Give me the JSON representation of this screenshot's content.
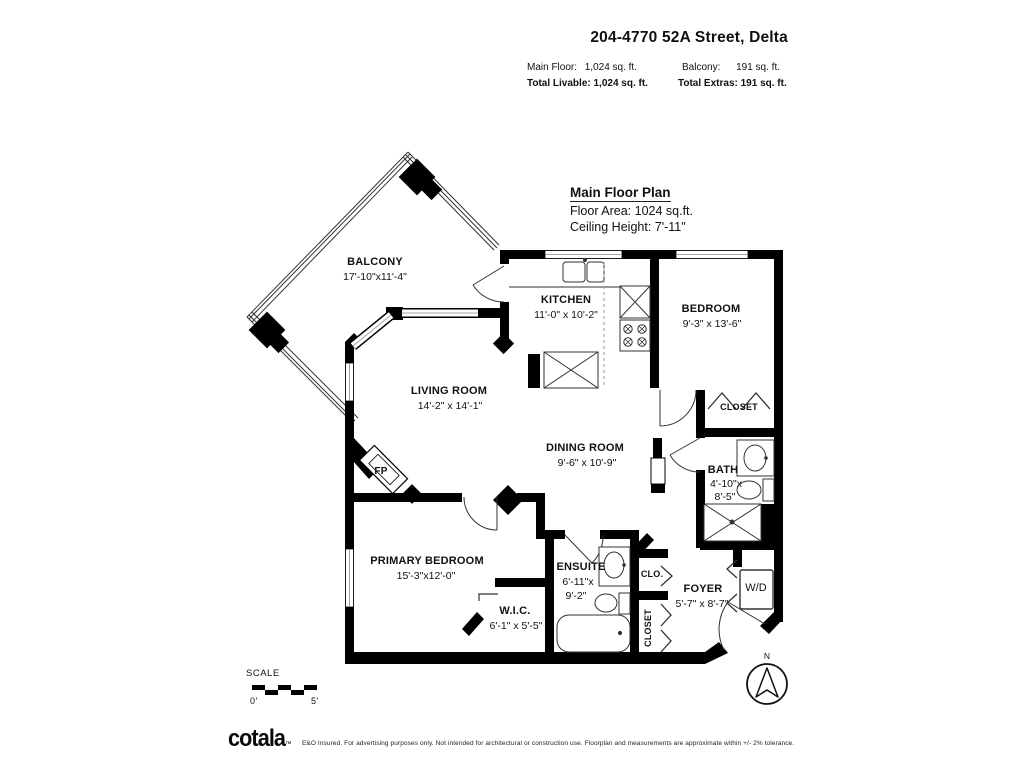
{
  "header": {
    "title": "204-4770 52A Street, Delta",
    "stats": {
      "main_floor_label": "Main Floor:",
      "main_floor_value": "1,024 sq. ft.",
      "total_livable": "Total Livable: 1,024 sq. ft.",
      "balcony_label": "Balcony:",
      "balcony_value": "191 sq. ft.",
      "total_extras": "Total Extras: 191 sq. ft."
    }
  },
  "plan_info": {
    "title": "Main Floor Plan",
    "floor_area": "Floor Area: 1024 sq.ft.",
    "ceiling_height": "Ceiling Height: 7'-11\""
  },
  "rooms": {
    "balcony": {
      "name": "BALCONY",
      "dims": "17'-10\"x11'-4\""
    },
    "kitchen": {
      "name": "KITCHEN",
      "dims": "11'-0\" x 10'-2\""
    },
    "bedroom": {
      "name": "BEDROOM",
      "dims": "9'-3\" x 13'-6\""
    },
    "living_room": {
      "name": "LIVING ROOM",
      "dims": "14'-2\" x 14'-1\""
    },
    "dining_room": {
      "name": "DINING ROOM",
      "dims": "9'-6\" x 10'-9\""
    },
    "bath": {
      "name": "BATH",
      "dims1": "4'-10\"x",
      "dims2": "8'-5\""
    },
    "primary_bedroom": {
      "name": "PRIMARY BEDROOM",
      "dims": "15'-3\"x12'-0\""
    },
    "wic": {
      "name": "W.I.C.",
      "dims": "6'-1\" x 5'-5\""
    },
    "ensuite": {
      "name": "ENSUITE",
      "dims1": "6'-11\"x",
      "dims2": "9'-2\""
    },
    "foyer": {
      "name": "FOYER",
      "dims": "5'-7\" x 8'-7\""
    }
  },
  "closets": {
    "bedroom_closet": "CLOSET",
    "clo": "CLO.",
    "foyer_closet": "CLOSET"
  },
  "fixtures": {
    "washer_dryer": "W/D",
    "fireplace": "FP"
  },
  "scale": {
    "label": "SCALE",
    "start": "0'",
    "end": "5'"
  },
  "compass": {
    "north": "N"
  },
  "footer": {
    "logo": "cotala",
    "logo_mark": "™",
    "disclaimer": "E&O Insured. For advertising purposes only. Not intended for architectural or construction use. Floorplan and measurements are approximate within +/- 2% tolerance."
  },
  "colors": {
    "wall": "#000000",
    "text": "#111111",
    "background": "#ffffff"
  }
}
